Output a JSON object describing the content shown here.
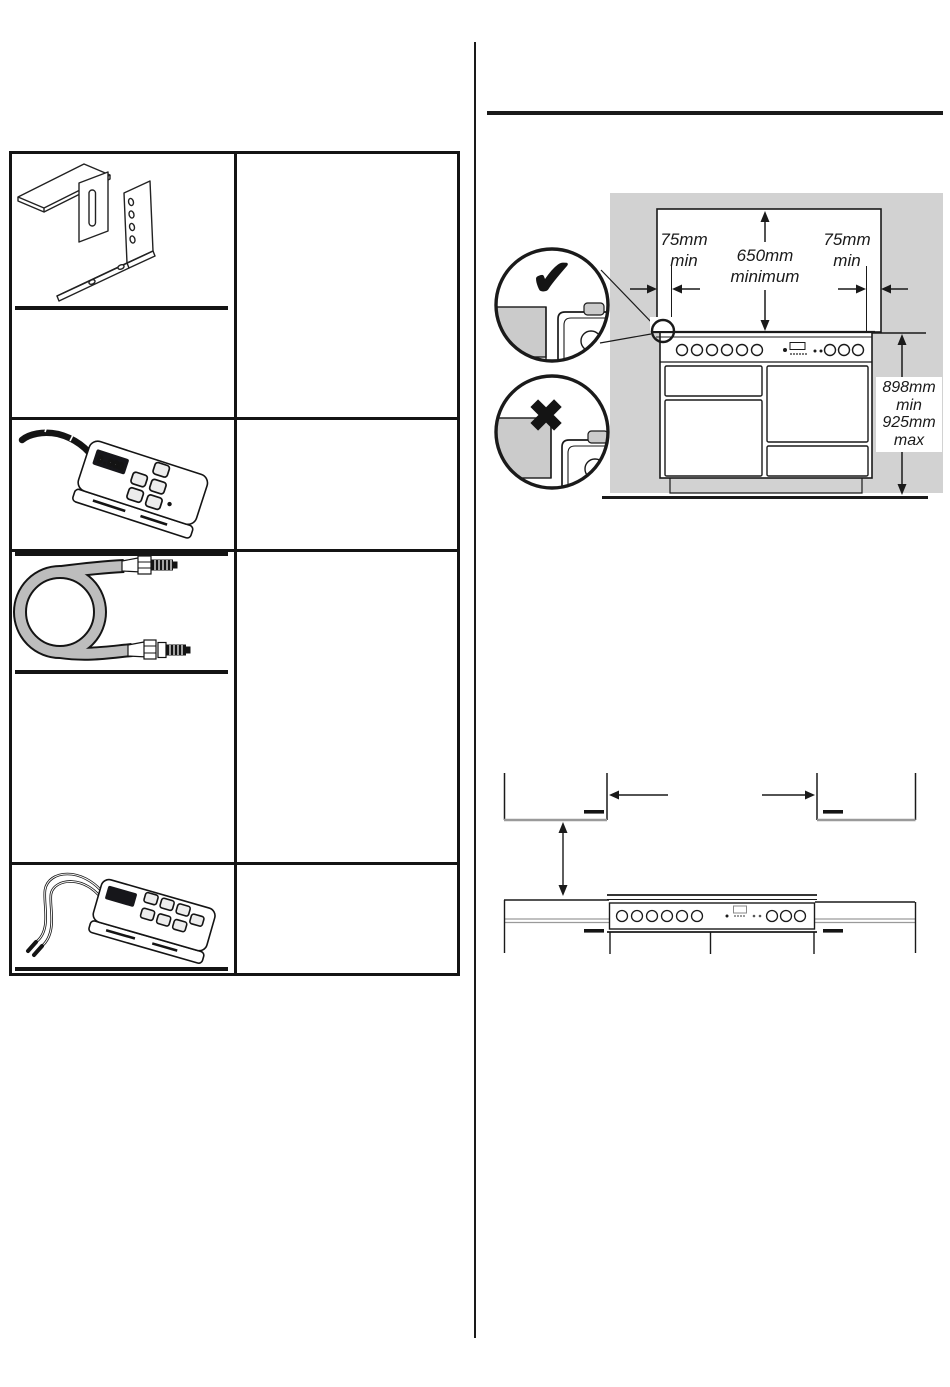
{
  "colors": {
    "ink": "#1a1a1a",
    "wall_gray": "#d2d2d2",
    "worktop_gray": "#cbcbcb",
    "hose_gray": "#bdbdbd"
  },
  "parts_table": {
    "rows": [
      {
        "illustration": "stability-bracket"
      },
      {
        "illustration": "electronic-tester-with-probe"
      },
      {
        "illustration": "flexible-gas-hose"
      },
      {
        "illustration": "electronic-tester-with-leads"
      }
    ]
  },
  "tester_display": "0.00Ω",
  "clearance_figure": {
    "left_clearance_l1": "75mm",
    "left_clearance_l2": "min",
    "center_clearance_l1": "650mm",
    "center_clearance_l2": "minimum",
    "right_clearance_l1": "75mm",
    "right_clearance_l2": "min",
    "height_l1": "898mm",
    "height_l2": "min",
    "height_l3": "925mm",
    "height_l4": "max",
    "correct_mark": "✔",
    "incorrect_mark": "✖"
  }
}
